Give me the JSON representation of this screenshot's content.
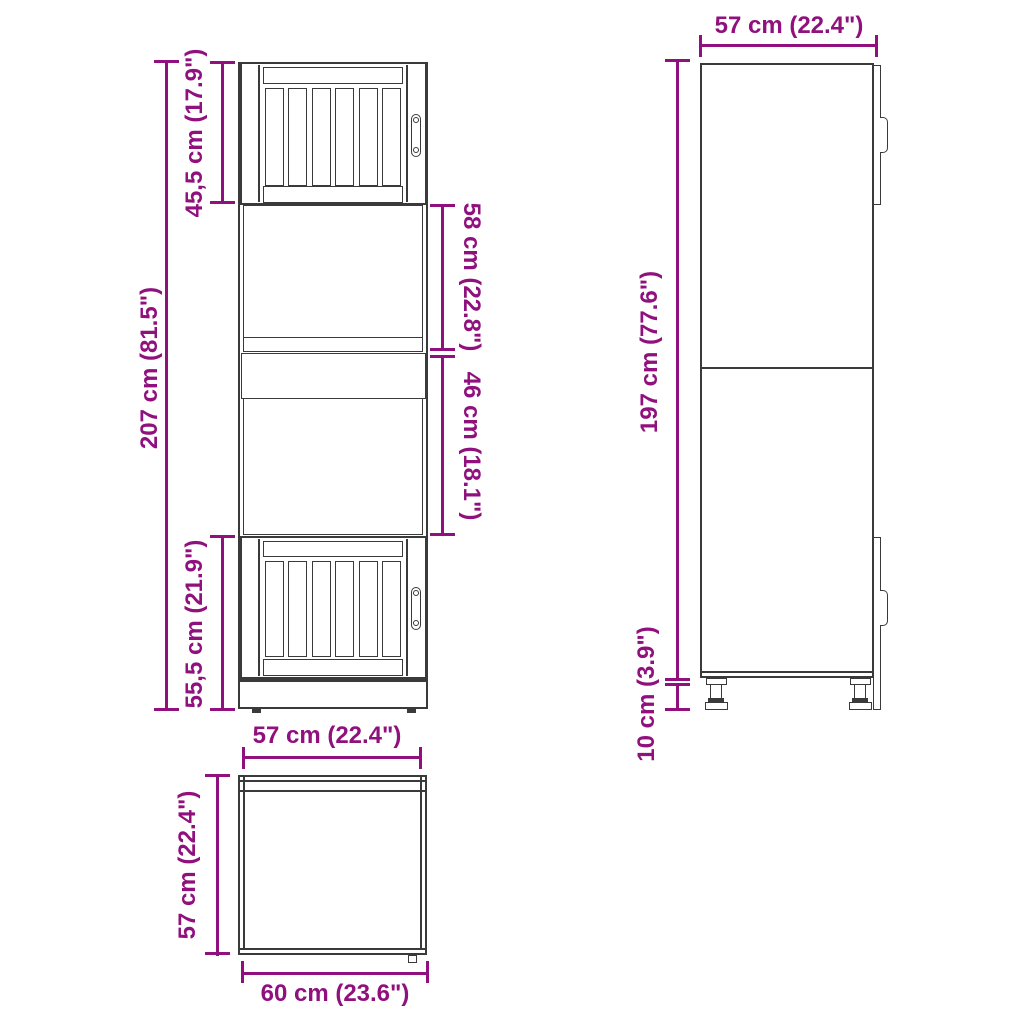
{
  "accent_color": "#90107E",
  "line_color": "#3a3a3a",
  "front_view": {
    "total_height": "207 cm (81.5\")",
    "top_door_height": "45,5 cm (17.9\")",
    "bottom_door_height": "55,5 cm (21.9\")",
    "upper_niche_height": "58 cm (22.8\")",
    "lower_niche_height": "46 cm (18.1\")"
  },
  "side_view": {
    "depth": "57 cm (22.4\")",
    "body_height": "197 cm (77.6\")",
    "leg_height": "10 cm (3.9\")"
  },
  "top_view": {
    "width": "57 cm (22.4\")",
    "depth": "57 cm (22.4\")",
    "total_depth": "60 cm (23.6\")"
  }
}
